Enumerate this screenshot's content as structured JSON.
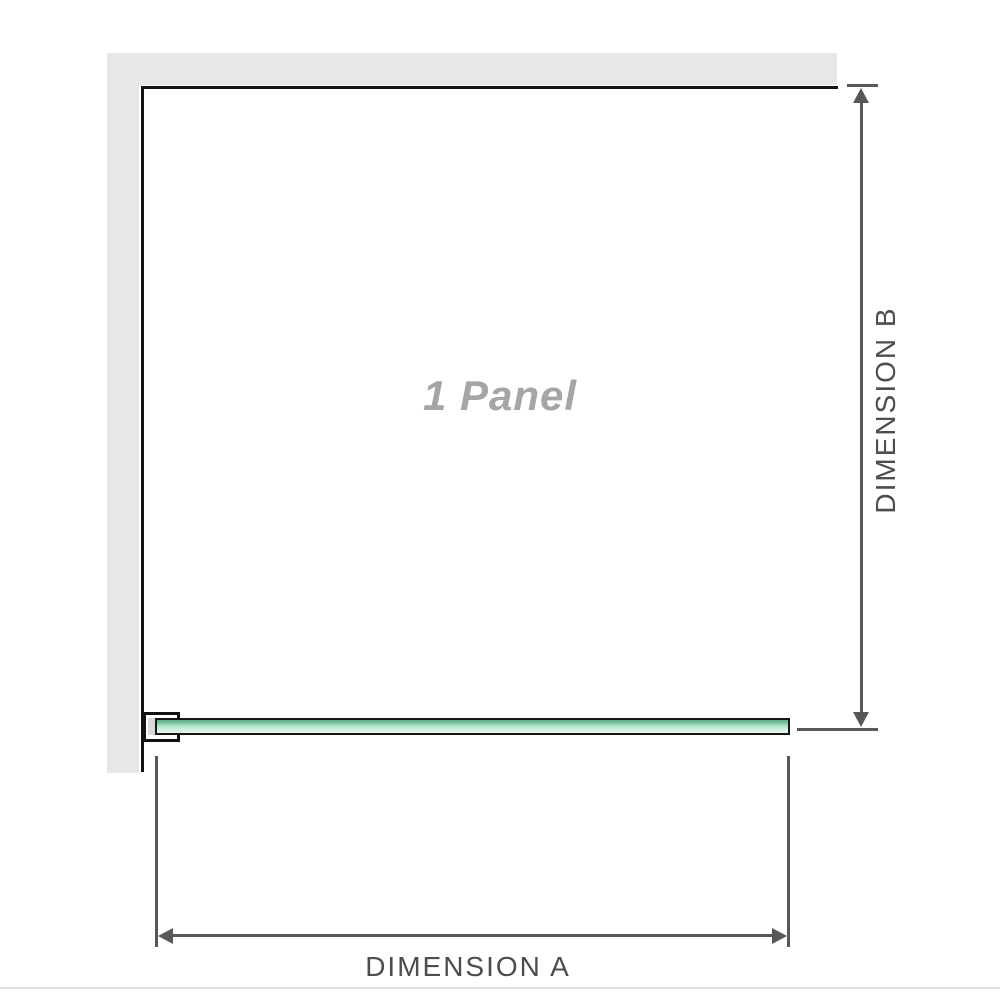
{
  "diagram": {
    "title": "Shower screen single panel dimension diagram",
    "panel_label": "1 Panel",
    "dimension_a": {
      "label": "DIMENSION A",
      "orientation": "horizontal"
    },
    "dimension_b": {
      "label": "DIMENSION B",
      "orientation": "vertical"
    }
  },
  "colors": {
    "wall_gray": "#e7e7e7",
    "panel_outline_black": "#141414",
    "dimension_line_gray": "#575757",
    "dimension_text_gray": "#4d4d4d",
    "panel_label_gray": "#a5a5a5",
    "glass_green_dark": "#5fae87",
    "glass_green_light": "#cdeede",
    "bracket_pad_gray": "#d9d9d9",
    "separator_gray": "#dfe3e6"
  }
}
